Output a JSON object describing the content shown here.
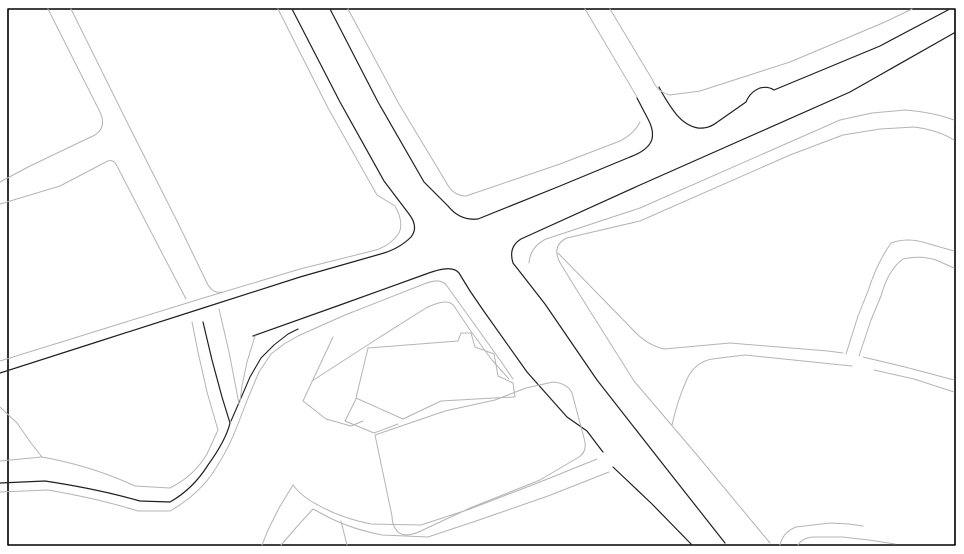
{
  "map": {
    "title": "street-map-line-drawing",
    "background_color": "#ffffff",
    "casing_color": "#1f1f1f",
    "minor_color": "#b4b4b4",
    "border": {
      "x": 8,
      "y": 9,
      "width": 947,
      "height": 536,
      "color": "#000000",
      "stroke_width": 1.6
    },
    "canvas": {
      "width": 964,
      "height": 554
    },
    "paths": [
      {
        "name": "main-road-west-casing-and-wsw-road-upper",
        "color": "#1f1f1f",
        "width": 1.2,
        "d": "M292,9 L340,102 L384,181 L409,214 Q419,227 411,237 Q400,248 384,253 L300,277 L200,309 L100,341 L0,373"
      },
      {
        "name": "main-road-east-casing-to-ne-fillet",
        "color": "#1f1f1f",
        "width": 1.2,
        "d": "M330,9 L378,102 L424,182 L448,206 Q460,221 478,219 L560,186 L630,157 Q649,150 652,139 Q654,130 648,119 L637,98"
      },
      {
        "name": "ne-arterial-north-casing-with-jog",
        "color": "#1f1f1f",
        "width": 1.2,
        "d": "M659,87 Q666,101 676,114 Q686,126 698,128 Q708,129 716,123 L746,102 Q750,92 760,88 Q768,86 774,90 L880,46 L948,10"
      },
      {
        "name": "ne-arterial-south-casing-and-se-road-east-casing",
        "color": "#1f1f1f",
        "width": 1.2,
        "d": "M725,543 L662,463 L597,380 L545,304 L513,263 Q508,247 521,239 L640,185 L850,92 L954,33"
      },
      {
        "name": "sw-wavy-road-casing-and-v1-south-edge",
        "color": "#1f1f1f",
        "width": 1.2,
        "d": "M0,483 L45,481 Q98,489 140,501 L170,502 Q193,489 208,465 Q226,440 230,423 L222,397 L212,360 L203,322"
      },
      {
        "name": "fork-branch-east-casing",
        "color": "#1f1f1f",
        "width": 1.1,
        "d": "M231,421 L241,398 L250,377 L261,358 L274,345 L288,334 L298,329"
      },
      {
        "name": "wsw-road-lower-casing-and-se-road-west-casing",
        "color": "#1f1f1f",
        "width": 1.2,
        "d": "M253,336 L340,305 L426,274 Q452,264 459,273 L470,291 L483,310 L527,372 L567,417 L587,431 Q599,447 603,452"
      },
      {
        "name": "se-road-west-casing-below-junction",
        "color": "#1f1f1f",
        "width": 1.2,
        "d": "M613,467 L652,504 L692,545"
      },
      {
        "name": "main-road-west-sidewalk-and-wsw-upper-parallel",
        "color": "#b4b4b4",
        "width": 1,
        "d": "M278,9 L328,108 L377,195 L395,206 Q404,222 399,233 Q391,245 376,250 L300,269 L200,299 L100,330 L0,361"
      },
      {
        "name": "main-road-east-sidewalk-and-block-corner",
        "color": "#b4b4b4",
        "width": 1,
        "d": "M348,9 L399,104 L446,182 Q453,196 466,196 L560,164 L620,141 Q634,134 640,122"
      },
      {
        "name": "top-side-street-west-edge",
        "color": "#b4b4b4",
        "width": 1,
        "d": "M585,9 L637,97"
      },
      {
        "name": "top-side-street-east-edge-and-ne-sidewalk",
        "color": "#b4b4b4",
        "width": 1,
        "d": "M610,9 L652,79 Q657,92 670,95 L700,91 L790,62 L885,22 L912,9"
      },
      {
        "name": "ne-arterial-inner-parallel-south",
        "color": "#b4b4b4",
        "width": 1,
        "d": "M529,263 Q530,247 546,239 L640,208 L790,142 L840,120 L872,113 L905,110 Q932,112 954,120"
      },
      {
        "name": "ne-arterial-outer-parallel-and-se-east-sidewalk",
        "color": "#b4b4b4",
        "width": 1,
        "d": "M770,543 L697,455 L634,381 L578,292 L559,261 Q552,245 567,238 L640,221 L790,155 L843,135 L880,129 L914,127 Q938,130 954,140"
      },
      {
        "name": "east-branch-road-upper-edge-west",
        "color": "#b4b4b4",
        "width": 1,
        "d": "M558,253 L636,333 Q648,345 664,349 L730,343 L828,351 L843,353"
      },
      {
        "name": "east-branch-road-upper-edge-east",
        "color": "#b4b4b4",
        "width": 1,
        "d": "M863,357 L905,367 L954,380"
      },
      {
        "name": "east-branch-road-lower-edge-west",
        "color": "#b4b4b4",
        "width": 1,
        "d": "M672,425 Q678,398 688,377 Q696,362 712,359 L745,355 L832,364 L852,366"
      },
      {
        "name": "east-branch-road-lower-edge-east",
        "color": "#b4b4b4",
        "width": 1,
        "d": "M874,370 L914,379 L954,392"
      },
      {
        "name": "nne-connector-west-edge",
        "color": "#b4b4b4",
        "width": 1,
        "d": "M846,354 L858,316 L868,291 Q877,263 891,243 Q908,237 926,243 L954,251"
      },
      {
        "name": "nne-connector-east-edge",
        "color": "#b4b4b4",
        "width": 1,
        "d": "M859,356 L871,320 L881,296 Q888,270 903,259 Q921,255 936,260 L954,268"
      },
      {
        "name": "nw-street-west-edge-and-h1-upper",
        "color": "#b4b4b4",
        "width": 1,
        "d": "M48,9 L100,112 Q107,127 95,135 L30,166 L0,182"
      },
      {
        "name": "nw-street-east-edge",
        "color": "#b4b4b4",
        "width": 1,
        "d": "M71,9 L130,128 L177,221 L208,285 Q214,294 222,292"
      },
      {
        "name": "h1-lower-edge-and-nw-street-west-mid",
        "color": "#b4b4b4",
        "width": 1,
        "d": "M0,204 L60,186 L104,163 Q113,157 117,166 L150,230 L186,299"
      },
      {
        "name": "v1-south-east-gray-edge",
        "color": "#b4b4b4",
        "width": 1,
        "d": "M219,309 L229,352 L236,388 L239,404"
      },
      {
        "name": "fork-branch-west-gray-edge",
        "color": "#b4b4b4",
        "width": 1,
        "d": "M255,336 L247,362 L242,386 L240,402"
      },
      {
        "name": "wavy-road-north-gray",
        "color": "#b4b4b4",
        "width": 1,
        "d": "M0,461 L42,457 Q92,466 135,486 L170,488 Q194,476 207,454 L218,430 L207,392 L198,352 L192,322"
      },
      {
        "name": "wavy-road-north-spur",
        "color": "#b4b4b4",
        "width": 1,
        "d": "M0,407 L17,423 L31,443 L42,457"
      },
      {
        "name": "wavy-road-south-gray-and-chevron-a",
        "color": "#b4b4b4",
        "width": 1,
        "d": "M0,492 L48,490 Q100,499 138,511 L170,511 Q200,494 216,468 Q230,446 238,424 L248,398 L259,372 L271,354 L284,344 L298,336 L345,315 L424,284 Q441,277 447,286 L462,307 L480,332 L500,360 L513,379"
      },
      {
        "name": "sliver-chevron-b",
        "color": "#b4b4b4",
        "width": 1,
        "d": "M312,381 L380,337 L426,308 Q448,297 454,306 L470,330 L492,360 L509,379"
      },
      {
        "name": "parcel-west-small",
        "color": "#b4b4b4",
        "width": 1,
        "d": "M333,337 L303,401 L326,419 L351,426 L363,421"
      },
      {
        "name": "parcel-notched-polygon",
        "color": "#b4b4b4",
        "width": 1,
        "d": "M368,348 L458,341 L461,333 L471,333 L475,347 L494,354 L498,376 L513,383 L515,397 L494,398 L441,401 L403,419 L356,398 Z"
      },
      {
        "name": "parcel-lower-left-quad",
        "color": "#b4b4b4",
        "width": 1,
        "d": "M356,399 L345,421 L374,433 L398,424"
      },
      {
        "name": "big-block-rounded",
        "color": "#b4b4b4",
        "width": 1,
        "d": "M375,435 L445,411 L495,400 L526,388 L553,382 Q567,383 572,393 L584,438 Q588,451 579,457 L540,480 L470,508 L425,529 Q406,539 398,532 Q392,526 392,516 L375,435 Z"
      },
      {
        "name": "bottom-road-north-edge",
        "color": "#b4b4b4",
        "width": 1,
        "d": "M597,459 L540,482 L470,509 L421,525 L371,524 Q341,518 318,505 Q302,497 293,485 L279,508 L268,530 L262,545"
      },
      {
        "name": "bottom-road-south-edge",
        "color": "#b4b4b4",
        "width": 1,
        "d": "M609,472 L548,496 L476,521 L428,537 L382,535 Q352,529 330,518 L313,509 L301,522 L281,545"
      },
      {
        "name": "bottom-road-stub",
        "color": "#b4b4b4",
        "width": 1,
        "d": "M341,521 L347,545"
      },
      {
        "name": "bottom-right-curve-upper",
        "color": "#b4b4b4",
        "width": 1,
        "d": "M780,545 Q783,532 796,527 L830,523 L849,524 L863,526"
      },
      {
        "name": "bottom-right-curve-lower",
        "color": "#b4b4b4",
        "width": 1,
        "d": "M798,545 Q802,538 813,537 L842,537 L869,540 L895,544"
      }
    ]
  }
}
